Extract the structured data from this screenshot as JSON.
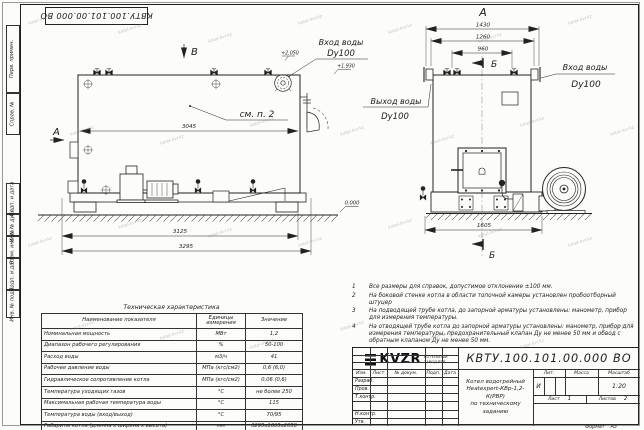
{
  "sheet": {
    "stamp_top": "КВТУ.100.101.00.000 ВО",
    "format_label": "Формат",
    "format_value": "А3",
    "watermark": "kotel-kvr.kz",
    "margin_labels": {
      "perv": "Перв. примен.",
      "sprav": "Справ. №",
      "podp1": "Подп. и дата",
      "inv_dubl": "Инв. № дубл.",
      "vzam": "Взам. инв. №",
      "podp2": "Подп. и дата",
      "inv_podl": "Инв. № подл."
    }
  },
  "side_view": {
    "mark_b": "В",
    "mark_a": "А",
    "see_note": "см. п. 2",
    "inlet_label": "Вход воды",
    "inlet_dn": "Dy100",
    "level_1": "+2.050",
    "level_2": "+1.930",
    "level_zero": "0.000",
    "dim_top": "3045",
    "dim_mid": "3125",
    "dim_total": "3295"
  },
  "front_view": {
    "view_label": "А",
    "section_b_top": "Б",
    "section_b_bottom": "Б",
    "inlet_label": "Вход воды",
    "inlet_dn": "Dy100",
    "outlet_label": "Выход воды",
    "outlet_dn": "Dy100",
    "dim_1": "1430",
    "dim_2": "1260",
    "dim_3": "960",
    "dim_base": "1605"
  },
  "notes": [
    {
      "num": "1",
      "text": "Все размеры для справок, допустимое отклонение ±100 мм."
    },
    {
      "num": "2",
      "text": "На боковой стенке котла в области топочной камеры установлен пробоотборный штуцер"
    },
    {
      "num": "3",
      "text": "На подводящей трубе котла, до запорной арматуры установлены: манометр, прибор для измерения температуры."
    },
    {
      "num": "4",
      "text": "На отводящей трубе котла до запорной арматуры установлены: манометр, прибор для измерения температуры, предохранительный клапан Ду не менее 50 мм и обвод с обратным клапаном Ду не менее 50 мм."
    }
  ],
  "tech_table": {
    "title": "Техническая характеристика",
    "headers": [
      "Наименование показателя",
      "Единицы измерения",
      "Значение"
    ],
    "rows": [
      [
        "Номинальная мощность",
        "МВт",
        "1,2"
      ],
      [
        "Диапазон рабочего регулирования",
        "%",
        "50-100"
      ],
      [
        "Расход воды",
        "м3/ч",
        "41"
      ],
      [
        "Рабочее давление воды",
        "МПа (кгс/см2)",
        "0,6 (6,0)"
      ],
      [
        "Гидравлическое сопротивление котла",
        "МПа (кгс/см2)",
        "0,06 (0,6)"
      ],
      [
        "Температура уходящих газов",
        "°С",
        "не более 250"
      ],
      [
        "Максимальная рабочая температура воды",
        "°С",
        "115"
      ],
      [
        "Температура воды (вход/выход)",
        "°С",
        "70/95"
      ],
      [
        "Габариты котла (длинна х ширина х высота)",
        "мм",
        "3295х1605х2050"
      ]
    ]
  },
  "title_block": {
    "doc_number": "КВТУ.100.101.00.000 ВО",
    "rev_headers": [
      "Изм.",
      "Лист",
      "№ докум.",
      "Подп.",
      "Дата"
    ],
    "roles": [
      "Разраб.",
      "Пров.",
      "Т.контр.",
      "",
      "Н.контр.",
      "Утв."
    ],
    "name_line1": "Котел водогрейный",
    "name_line2": "Heatexpert-КВр-1,2-К(РВР)",
    "name_line3": "по техническому заданию",
    "lit_header": "Лит.",
    "mass_header": "Масса",
    "scale_header": "Масштаб",
    "lit_value": "И",
    "scale_value": "1:20",
    "sheet_label": "Лист",
    "sheet_value": "1",
    "sheets_label": "Листов",
    "sheets_value": "2",
    "logo_text": "KVZR",
    "logo_caption_line1": "КОТЕЛЬНЫЙ",
    "logo_caption_line2": "ЗАВОД РЭП"
  }
}
